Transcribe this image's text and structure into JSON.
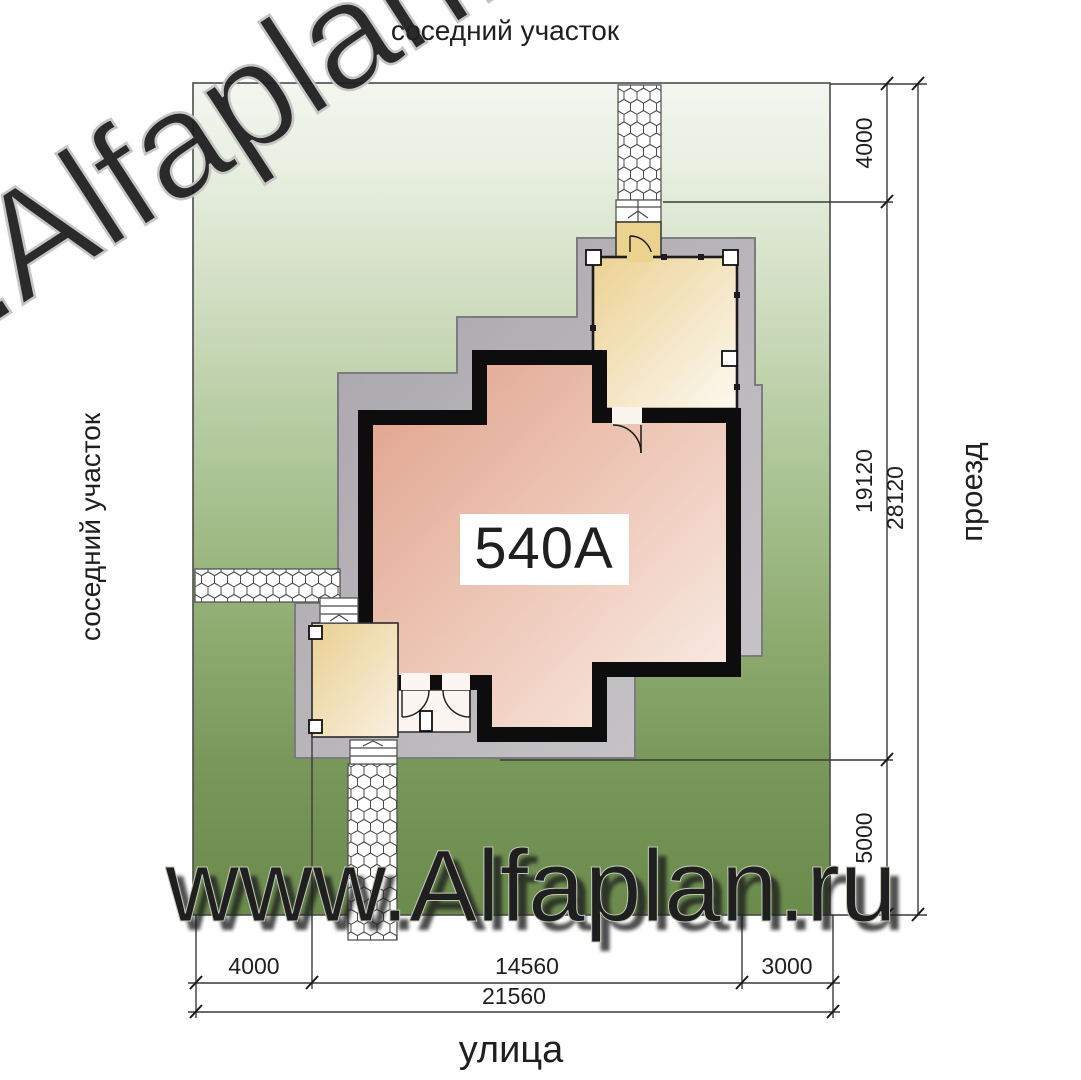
{
  "title": "Site plan 540A",
  "plan": {
    "number": "540A"
  },
  "labels": {
    "top": "соседний участок",
    "left": "соседний участок",
    "right": "проезд",
    "street": "улица"
  },
  "watermark": {
    "text": "www.Alfaplan.ru"
  },
  "dims_right": [
    "4000",
    "19120",
    "28120",
    "5000"
  ],
  "dims_bottom": [
    "4000",
    "14560",
    "3000",
    "21560"
  ],
  "chart_colors": {
    "plot_green_top": "#f3f6ee",
    "plot_green_bottom": "#6a8b4c",
    "terrace_gray": "#b5b2b6",
    "wall_black": "#0d0d0d",
    "house_pink": "#dfa28c",
    "veranda_cream": "#ecd193",
    "porch_tan": "#e9cf92",
    "watermark_light": "#e5eadc"
  }
}
